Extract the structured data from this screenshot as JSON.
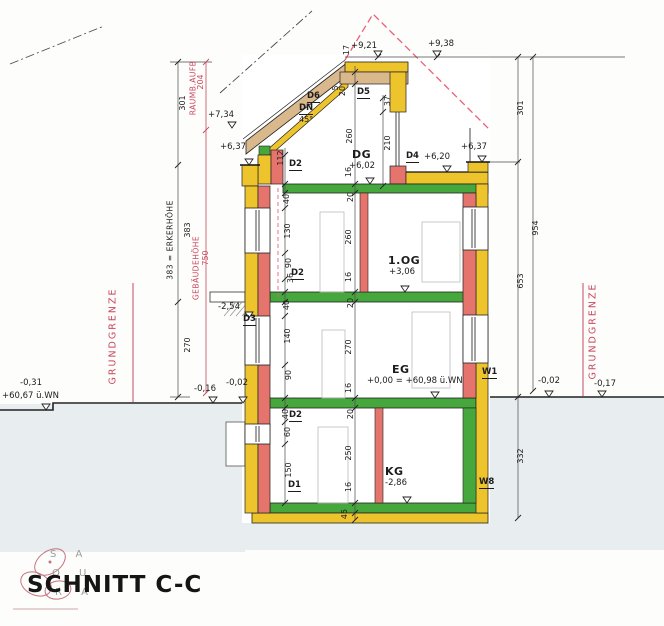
{
  "colors": {
    "insulation": "#eec42d",
    "masonry": "#e4746c",
    "slab": "#46a83c",
    "wood": "#d9b88c",
    "dim_red": "#c9485f",
    "dash_red": "#ee5e78",
    "soil": "#e8edef"
  },
  "title_block": {
    "title": "SCHNITT C-C",
    "logo_lines": [
      "S A",
      "Q U",
      "R A"
    ]
  },
  "rooms": {
    "dg": "DG",
    "og": "1.OG",
    "eg": "EG",
    "kg": "KG"
  },
  "levels": {
    "r921": "+9,21",
    "r938": "+9,38",
    "r734": "+7,34",
    "l637": "+6,37",
    "r637": "+6,37",
    "t620": "+6,20",
    "dg602": "+6,02",
    "og306": "+3,06",
    "eg000": "+0,00 = +60,98 ü.WN",
    "kg286": "-2,86",
    "c254": "-2,54",
    "gl6067": "+60,67 ü.WN",
    "gm031": "-0,31",
    "gm016": "-0,16",
    "gm002l": "-0,02",
    "gm002r": "-0,02",
    "gm017": "-0,17"
  },
  "openings": {
    "d1": "D1",
    "d2": "D2",
    "d3": "D3",
    "d4": "D4",
    "d5": "D5",
    "d6": "D6",
    "w1": "W1",
    "w8": "W8",
    "dn": "DN",
    "pitch": "45°"
  },
  "dims": {
    "roof_edge": "17",
    "roof_5": "5",
    "roof_20": "20",
    "dg_height": "260",
    "dormer_lintel": "37",
    "dormer_window": "210",
    "dg_d2": "112",
    "dg_slab": "16",
    "og_40": "40",
    "og_130": "130",
    "og_90": "90",
    "og_36": "36",
    "og_20": "20",
    "og_height": "260",
    "og_slab": "16",
    "eg_40": "40",
    "eg_140": "140",
    "eg_90": "90",
    "eg_20": "20",
    "eg_height": "270",
    "eg_slab": "16",
    "kg_40": "40",
    "kg_60": "60",
    "kg_150": "150",
    "kg_20": "20",
    "kg_height": "250",
    "kg_slab": "16",
    "base_slab": "45",
    "left_301": "301",
    "erker": "383 = ERKERHÖHE",
    "left_383": "383",
    "left_270": "270",
    "raum_204": "204",
    "raum_label": "RAUMB.AUFB",
    "geb_750": "750",
    "geb_label": "GEBÄUDEHÖHE",
    "right_301": "301",
    "right_954": "954",
    "right_653": "653",
    "right_332": "332"
  },
  "site": {
    "grundgrenze_left": "GRUNDGRENZE",
    "grundgrenze_right": "GRUNDGRENZE"
  }
}
